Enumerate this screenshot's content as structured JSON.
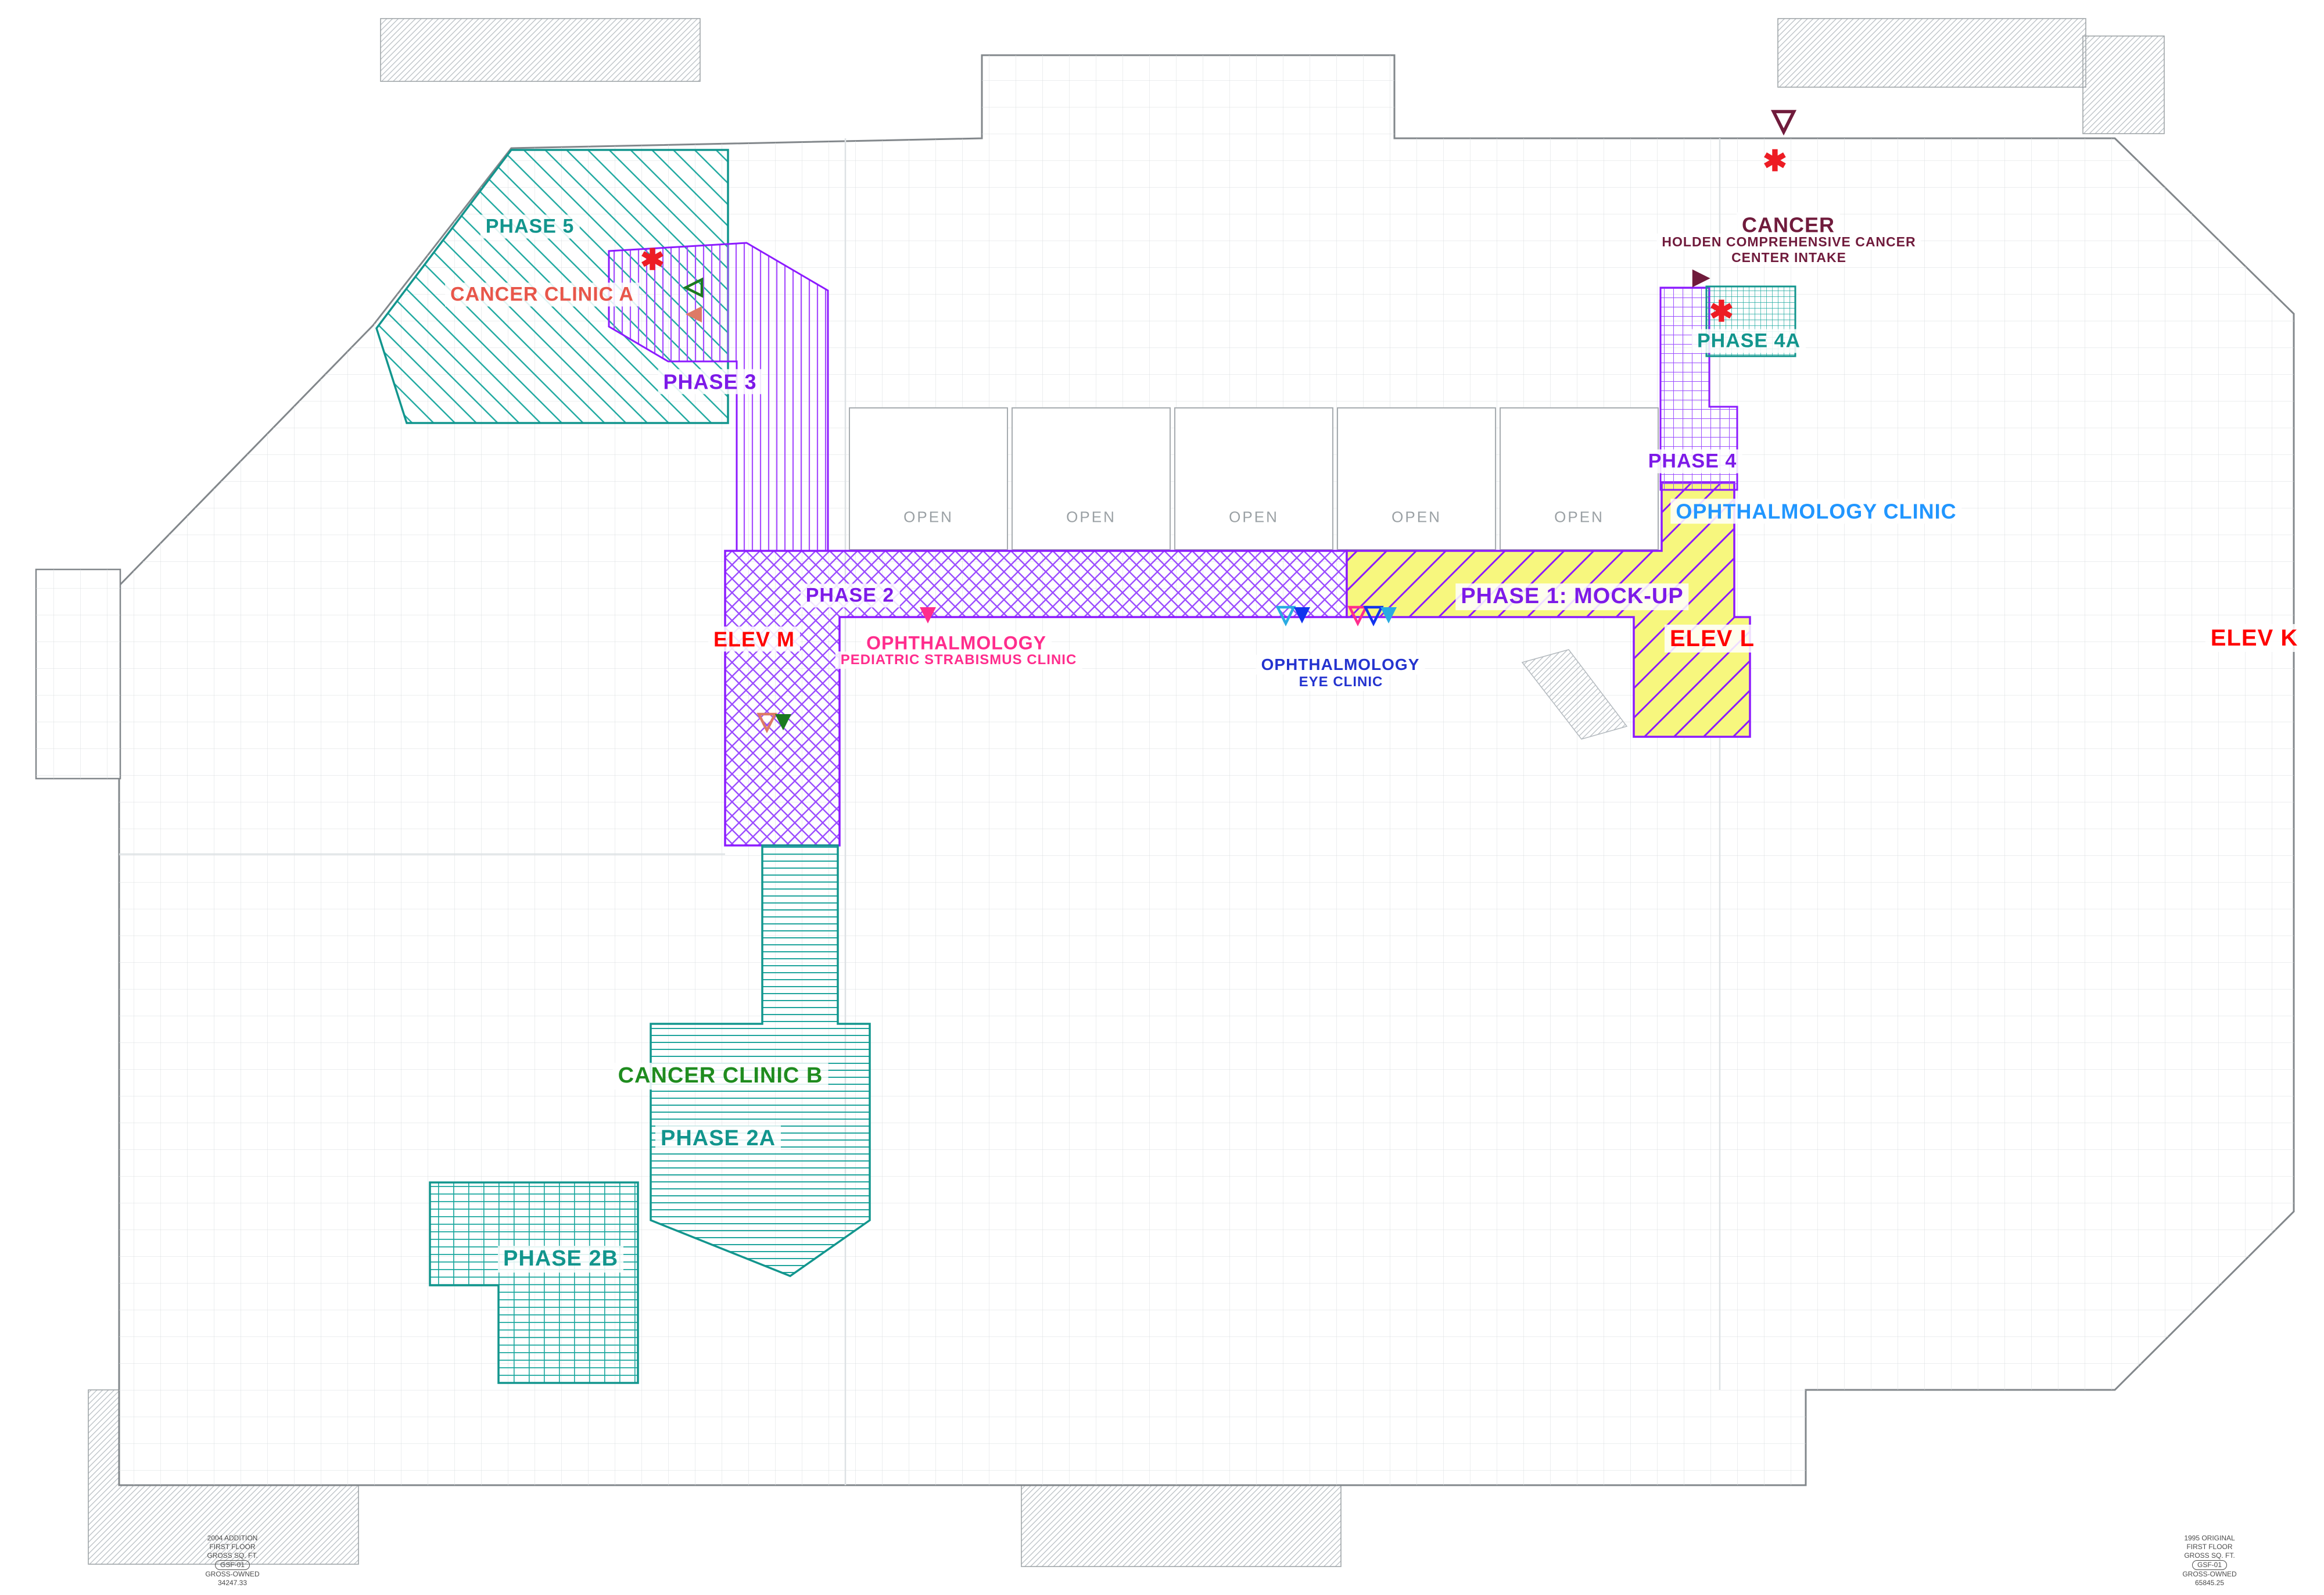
{
  "document": {
    "type": "hospital first-floor phasing plan",
    "floor": "FIRST FLOOR"
  },
  "colors": {
    "teal": "#12958d",
    "purple": "#8c1aff",
    "yellow_fill": "#f7f77e",
    "red": "#ff0000",
    "bright_red": "#ed1c24",
    "maroon": "#701b3c",
    "pink": "#ff2d8d",
    "blue": "#2433cf",
    "light_blue": "#2196ff",
    "green": "#1f8c1f",
    "salmon": "#dd7a66",
    "cyan": "#29abe2",
    "gray": "#9aa0a4"
  },
  "phases": [
    {
      "id": "phase-5",
      "label": "PHASE 5",
      "color": "#12958d",
      "hatch": "diagonal-lines"
    },
    {
      "id": "phase-3",
      "label": "PHASE 3",
      "color": "#8c1aff",
      "hatch": "vertical-lines"
    },
    {
      "id": "phase-2",
      "label": "PHASE 2",
      "color": "#8c1aff",
      "hatch": "basketweave"
    },
    {
      "id": "phase-1",
      "label": "PHASE 1: MOCK-UP",
      "color": "#8c1aff",
      "fill": "#f7f77e",
      "hatch": "diagonal-lines-on-yellow"
    },
    {
      "id": "phase-4",
      "label": "PHASE 4",
      "color": "#8c1aff",
      "hatch": "grid"
    },
    {
      "id": "phase-4a",
      "label": "PHASE 4A",
      "color": "#12958d",
      "hatch": "fine-grid"
    },
    {
      "id": "phase-2a",
      "label": "PHASE 2A",
      "color": "#12958d",
      "hatch": "horizontal-lines"
    },
    {
      "id": "phase-2b",
      "label": "PHASE 2B",
      "color": "#12958d",
      "hatch": "grid"
    }
  ],
  "areas": [
    {
      "id": "cancer-clinic-a",
      "label": "CANCER CLINIC A",
      "color": "#e8564a"
    },
    {
      "id": "cancer-clinic-b",
      "label": "CANCER CLINIC B",
      "color": "#1f8c1f"
    },
    {
      "id": "ophthalmology-pediatric",
      "line1": "OPHTHALMOLOGY",
      "line2": "PEDIATRIC STRABISMUS CLINIC",
      "color": "#ff2d8d"
    },
    {
      "id": "ophthalmology-eye",
      "line1": "OPHTHALMOLOGY",
      "line2": "EYE CLINIC",
      "color": "#2433cf"
    },
    {
      "id": "ophthalmology-clinic",
      "label": "OPHTHALMOLOGY CLINIC",
      "color": "#2196ff"
    },
    {
      "id": "cancer-center-intake",
      "line1": "CANCER",
      "line2": "HOLDEN COMPREHENSIVE CANCER",
      "line3": "CENTER INTAKE",
      "color": "#701b3c"
    }
  ],
  "elevators": [
    {
      "id": "elev-m",
      "label": "ELEV M",
      "color": "#ff0000"
    },
    {
      "id": "elev-l",
      "label": "ELEV L",
      "color": "#ff0000"
    },
    {
      "id": "elev-k",
      "label": "ELEV K",
      "color": "#ff0000"
    }
  ],
  "open_areas": [
    "OPEN",
    "OPEN",
    "OPEN",
    "OPEN",
    "OPEN"
  ],
  "markers": {
    "asterisk_glyph": "✱",
    "asterisks": [
      {
        "color": "#ed1c24",
        "location": "phase-3-entry"
      },
      {
        "color": "#ed1c24",
        "location": "northeast-wing-entry"
      },
      {
        "color": "#ed1c24",
        "location": "phase-4a-information-desk"
      }
    ],
    "triangles": [
      {
        "direction": "left",
        "style": "outline",
        "color": "#1b7a1f",
        "location": "phase-3"
      },
      {
        "direction": "left",
        "style": "filled",
        "color": "#dd7a66",
        "location": "phase-3"
      },
      {
        "direction": "down",
        "style": "outline",
        "color": "#701b3c",
        "location": "northeast-wing-entry"
      },
      {
        "direction": "right",
        "style": "filled",
        "color": "#701b3c",
        "location": "cancer-intake-information-desk"
      },
      {
        "direction": "down",
        "style": "filled",
        "color": "#ff2d8d",
        "location": "phase-2-pediatric-strabismus"
      },
      {
        "direction": "down",
        "style": "outline",
        "color": "#dd7a66",
        "location": "elev-m-lobby"
      },
      {
        "direction": "down",
        "style": "filled",
        "color": "#1b7a1f",
        "location": "elev-m-lobby"
      },
      {
        "direction": "down",
        "style": "outline",
        "color": "#29abe2",
        "location": "phase-1-west"
      },
      {
        "direction": "down",
        "style": "filled",
        "color": "#1133ee",
        "location": "phase-1-west"
      },
      {
        "direction": "down",
        "style": "outline",
        "color": "#ff2d8d",
        "location": "phase-1-center"
      },
      {
        "direction": "down",
        "style": "outline",
        "color": "#1133ee",
        "location": "phase-1-center"
      },
      {
        "direction": "down",
        "style": "filled",
        "color": "#29abe2",
        "location": "phase-1-center"
      }
    ]
  },
  "corner_notes": {
    "left": {
      "lines": [
        "2004 ADDITION",
        "FIRST FLOOR",
        "GROSS SQ. FT.",
        "GSF-01",
        "GROSS-OWNED",
        "34247.33"
      ]
    },
    "right": {
      "lines": [
        "1995 ORIGINAL",
        "FIRST FLOOR",
        "GROSS SQ. FT.",
        "GSF-01",
        "GROSS-OWNED",
        "65845.25"
      ]
    }
  }
}
